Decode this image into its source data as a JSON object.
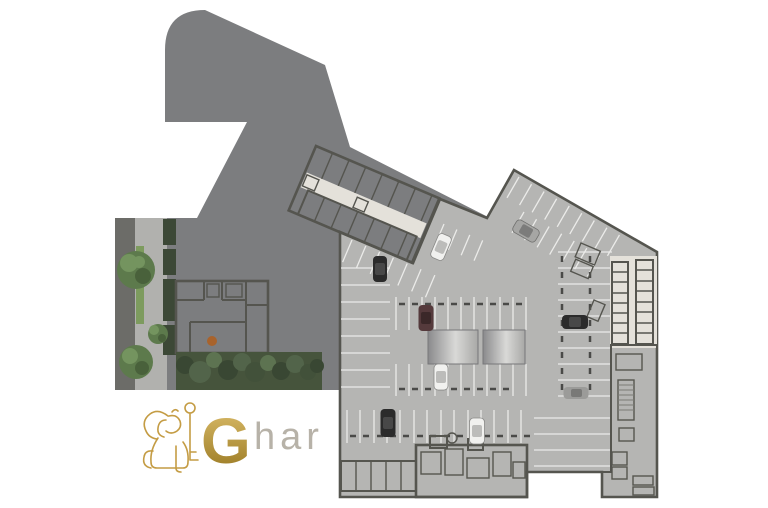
{
  "logo": {
    "mark": "lion-with-key",
    "g": "G",
    "rest": "har",
    "wordmark": "Ghar"
  },
  "palette": {
    "page": "#ffffff",
    "podium": "#7c7d7f",
    "garage": "#b5b5b3",
    "wall": "#55554f",
    "floor": "#e4e1da",
    "room": "#aeaca8",
    "storage": "#c6c4c0",
    "whiteroom": "#efeeea",
    "line": "#ebebe9",
    "stop": "#4a4a48",
    "strip": "#6c6c68",
    "path": "#b1b1ae",
    "grass": "#7d9b5e",
    "green1": "#74945f",
    "green2": "#5d7a4c",
    "green3": "#49613b",
    "green4": "#3c4836",
    "veg": "#46543c",
    "rampd": "#8a8a8c",
    "rampl": "#d9d9d7",
    "rampm": "#a8a8a6",
    "gold": "#c49c44",
    "gold2": "#dcbd6b",
    "gold3": "#96761f",
    "har": "#b7b2a8",
    "carblack": "#2b2b2b",
    "carwhite": "#f1f1ef",
    "cargray": "#9b9b99",
    "carsilver": "#a6a6a4",
    "carmaroon": "#553a3c",
    "table": "#a8632c"
  },
  "scene": {
    "kind": "architectural basement parking floor plan",
    "features": [
      "podium outline",
      "landscaped courtyard with trees",
      "apartment unit layout",
      "parking stalls",
      "driveway ramp slabs",
      "storage rooms",
      "stair and elevator cores"
    ],
    "tree_count": 3,
    "car_colors": [
      "white",
      "black",
      "silver",
      "black",
      "maroon",
      "white",
      "black",
      "white",
      "gray"
    ]
  }
}
